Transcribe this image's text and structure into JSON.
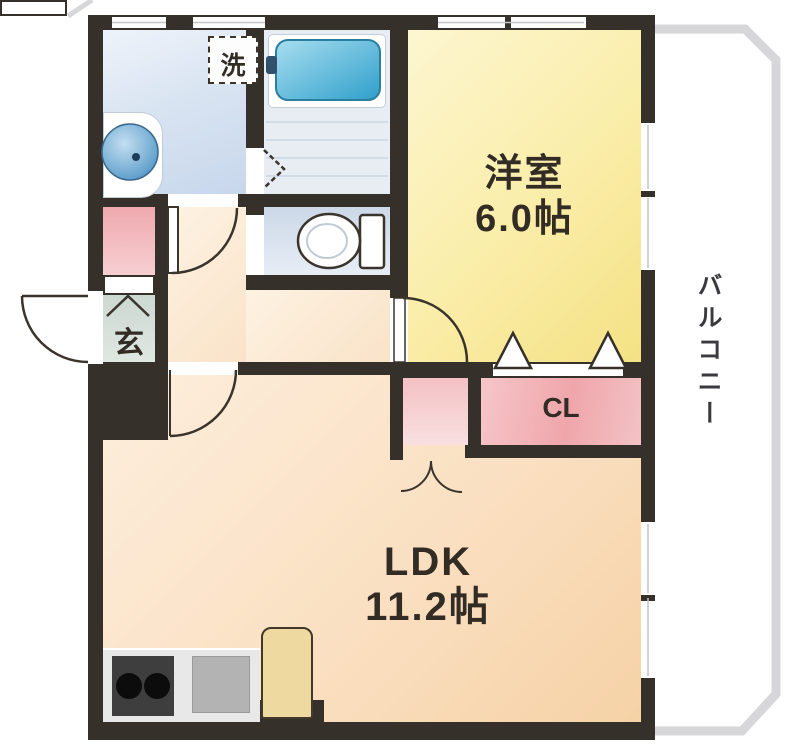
{
  "rooms": {
    "western": {
      "name": "洋室",
      "size": "6.0帖"
    },
    "ldk": {
      "name": "LDK",
      "size": "11.2帖"
    },
    "closet": {
      "label": "CL"
    },
    "entrance": {
      "label": "玄"
    },
    "laundry": {
      "label": "洗"
    },
    "balcony": {
      "label": "バルコニー"
    }
  },
  "fixtures": {
    "bathtub": "bathtub",
    "wash_basin": "wash-basin",
    "toilet": "toilet",
    "washing_machine_space": "washing-machine-space",
    "gas_stove": "gas-stove-two-burners",
    "kitchen_sink": "kitchen-sink",
    "water_heater": "water-heater"
  },
  "colors": {
    "wall": "#36302a",
    "western_room_fill": "#f8eca4",
    "ldk_fill": "#fae1c0",
    "closet_pink": "#f2b3b7",
    "sanitary_blue": "#d5e1f0",
    "bathtub_blue": "#4fb2d8",
    "entrance_floor": "#d7e0da",
    "balcony_line": "#d7d7d9",
    "text": "#322c25"
  }
}
